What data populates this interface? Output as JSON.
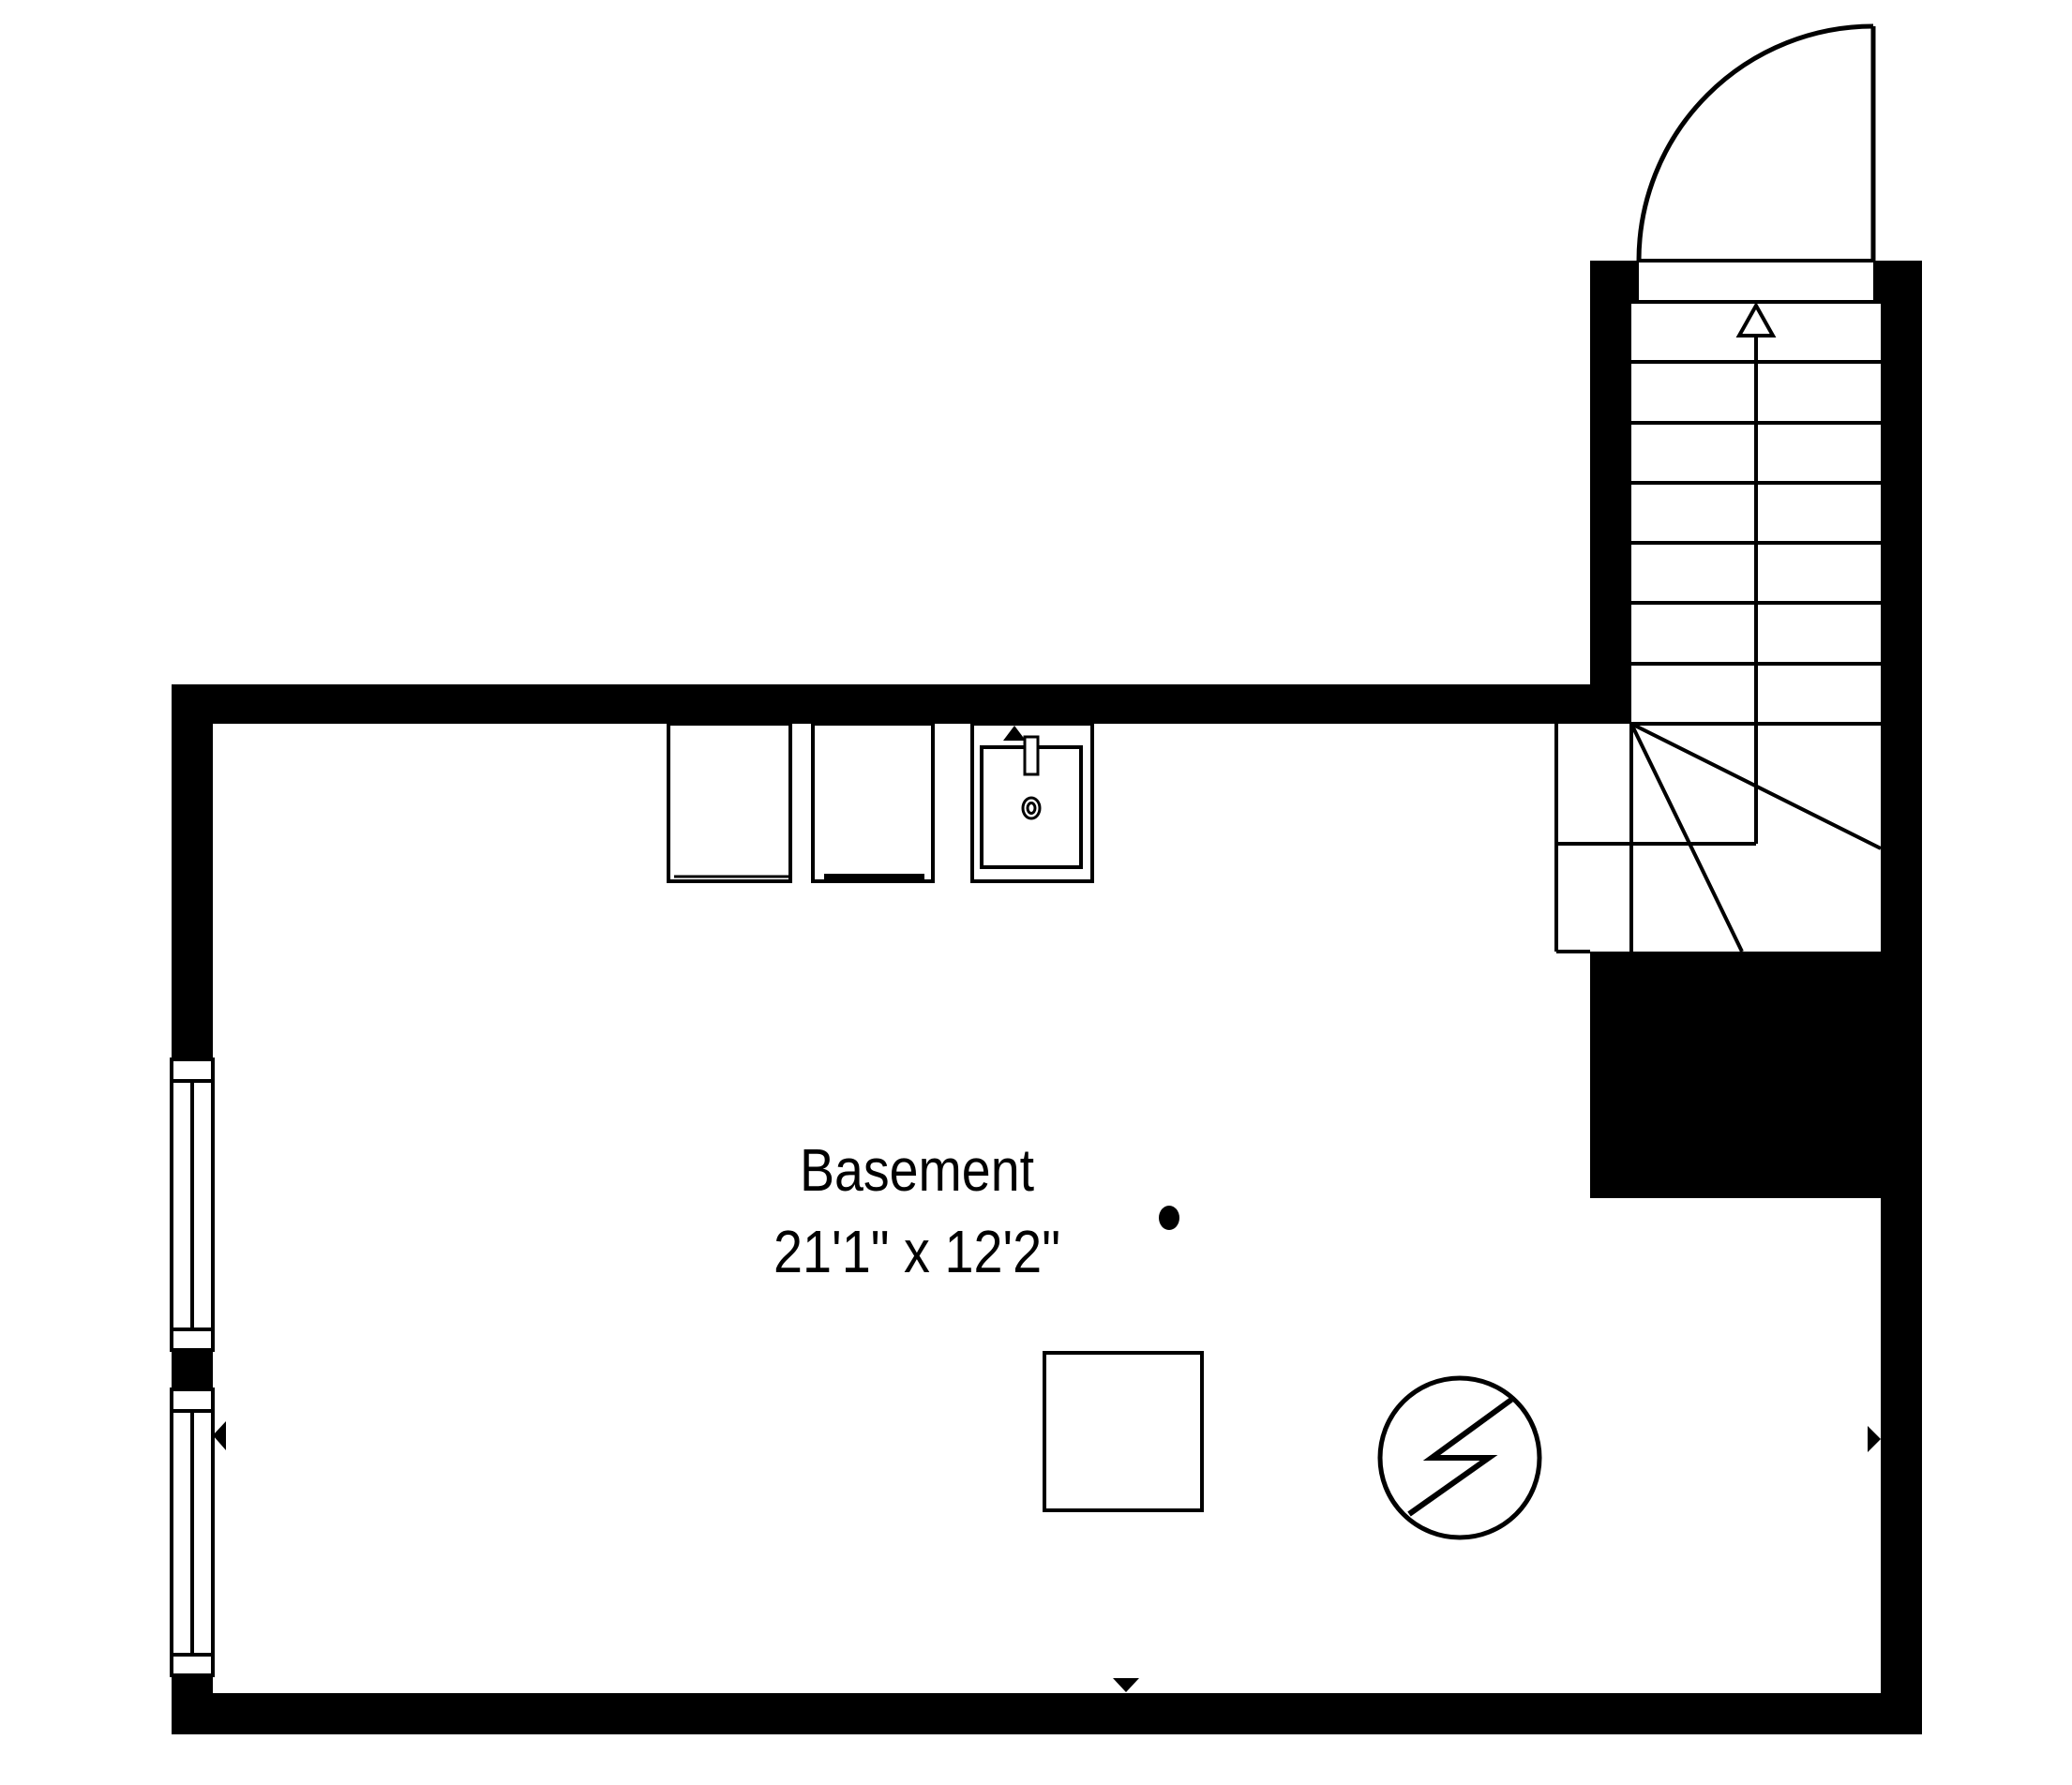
{
  "floorplan": {
    "room_label": {
      "name": "Basement",
      "dimensions": "21'1\" x 12'2\""
    },
    "colors": {
      "walls": "#000000",
      "lines": "#000000",
      "background": "#ffffff"
    },
    "stairs": {
      "arrow_direction": "up",
      "straight_treads": 7,
      "has_winders": true
    },
    "door": {
      "type": "hinged-swing",
      "location": "top-of-stairs"
    },
    "windows": [
      {
        "name": "upper-left-window",
        "panes": 2
      },
      {
        "name": "lower-left-window",
        "panes": 2
      }
    ],
    "fixtures": [
      {
        "name": "appliance-1"
      },
      {
        "name": "appliance-2"
      },
      {
        "name": "sink"
      }
    ],
    "symbols": [
      {
        "name": "utility-circle-bolt"
      },
      {
        "name": "floor-dot"
      },
      {
        "name": "support-square"
      }
    ],
    "dimension_markers": [
      {
        "side": "top",
        "direction": "up"
      },
      {
        "side": "bottom",
        "direction": "down"
      },
      {
        "side": "left",
        "direction": "left"
      },
      {
        "side": "right",
        "direction": "right"
      }
    ]
  }
}
